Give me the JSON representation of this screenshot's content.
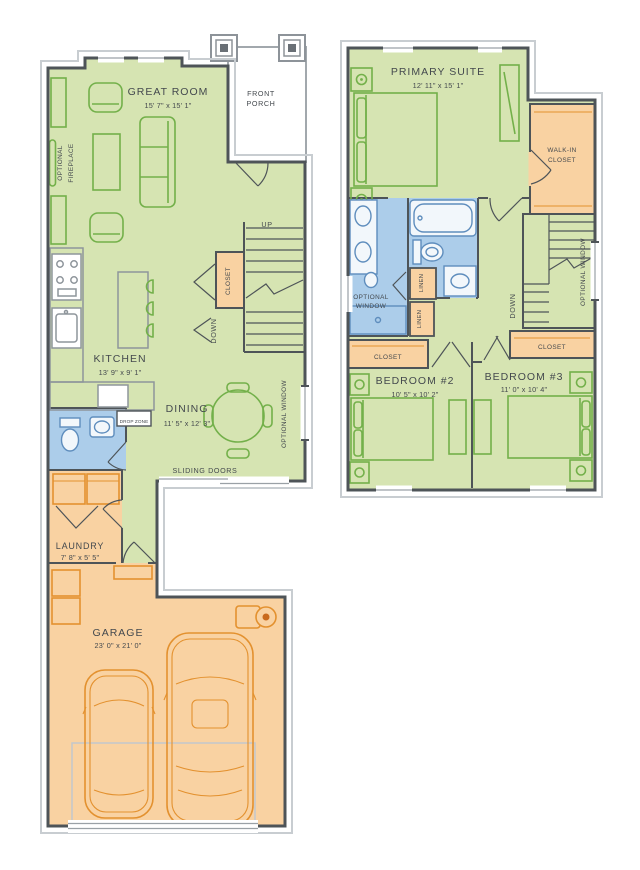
{
  "palette": {
    "room_green": "#d6e4b2",
    "room_orange": "#f9d2a2",
    "room_blue": "#accdea",
    "wall": "#4e5458",
    "accent_green": "#73b04a",
    "accent_orange": "#e3912f",
    "accent_blue": "#5e8dbd",
    "text": "#44494e"
  },
  "floor1": {
    "great_room": {
      "name": "GREAT ROOM",
      "dims": "15' 7\" x 15' 1\""
    },
    "front_porch": {
      "line1": "FRONT",
      "line2": "PORCH"
    },
    "optional_fireplace": {
      "line1": "OPTIONAL",
      "line2": "FIREPLACE"
    },
    "kitchen": {
      "name": "KITCHEN",
      "dims": "13' 9\" x 9' 1\""
    },
    "dining": {
      "name": "DINING",
      "dims": "11' 5\" x 12' 3\""
    },
    "closet_label": "CLOSET",
    "drop_zone_label": "DROP ZONE",
    "laundry": {
      "name": "LAUNDRY",
      "dims": "7' 8\" x 5' 5\""
    },
    "garage": {
      "name": "GARAGE",
      "dims": "23' 0\" x 21' 0\""
    },
    "sliding_doors_label": "SLIDING DOORS",
    "optional_window_label": "OPTIONAL WINDOW",
    "up_label": "UP",
    "down_label": "DOWN"
  },
  "floor2": {
    "primary_suite": {
      "name": "PRIMARY SUITE",
      "dims": "12' 11\" x 15' 1\""
    },
    "walk_in_closet": {
      "line1": "WALK-IN",
      "line2": "CLOSET"
    },
    "optional_window": {
      "line1": "OPTIONAL",
      "line2": "WINDOW"
    },
    "optional_window_side_label": "OPTIONAL WINDOW",
    "linen_label": "LINEN",
    "down_label": "DOWN",
    "closet_label": "CLOSET",
    "bedroom2": {
      "name": "BEDROOM #2",
      "dims": "10' 5\" x 10' 2\""
    },
    "bedroom3": {
      "name": "BEDROOM #3",
      "dims": "11' 0\" x 10' 4\""
    }
  }
}
